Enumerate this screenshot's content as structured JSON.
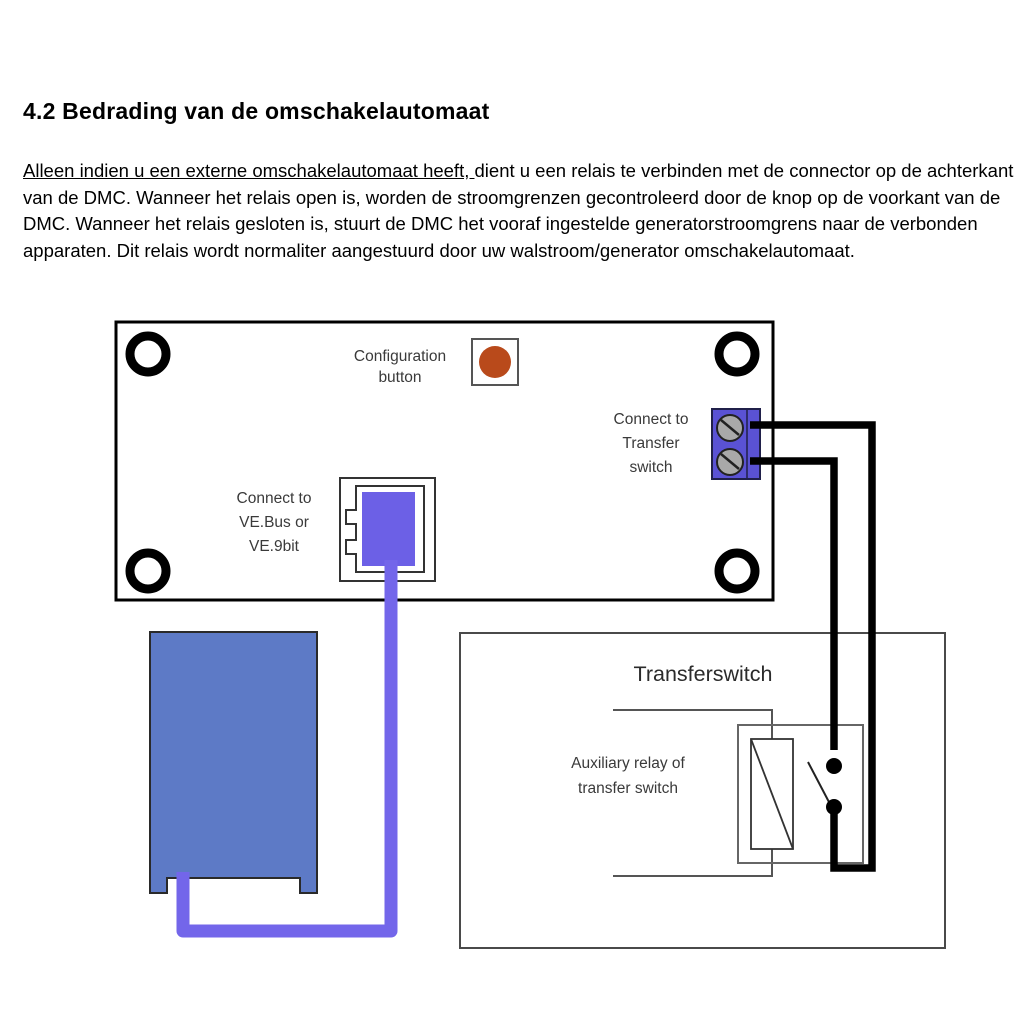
{
  "page": {
    "heading": "4.2 Bedrading van de omschakelautomaat",
    "paragraph": {
      "underlined": "Alleen indien u een externe omschakelautomaat heeft, ",
      "rest": "dient u een relais te verbinden met de connector op de achterkant van de DMC. Wanneer het relais open is, worden de stroomgrenzen gecontroleerd door de knop op de voorkant van de DMC. Wanneer het relais gesloten is, stuurt de DMC het vooraf ingestelde generatorstroomgrens naar de verbonden apparaten. Dit relais wordt normaliter aangestuurd door uw walstroom/generator omschakelautomaat."
    }
  },
  "diagram": {
    "labels": {
      "config_l1": "Configuration",
      "config_l2": "button",
      "transfer_l1": "Connect to",
      "transfer_l2": "Transfer",
      "transfer_l3": "switch",
      "vebus_l1": "Connect to",
      "vebus_l2": "VE.Bus or",
      "vebus_l3": "VE.9bit",
      "transferswitch_title": "Transferswitch",
      "auxrelay_l1": "Auxiliary relay of",
      "auxrelay_l2": "transfer switch"
    },
    "colors": {
      "button_orange": "#b94a1b",
      "terminal_blue": "#5a52d4",
      "plug_purple": "#6c60e6",
      "cable_purple": "#7366ea",
      "device_blue": "#5d7ac6",
      "screw_gray": "#a9a9a9"
    }
  }
}
